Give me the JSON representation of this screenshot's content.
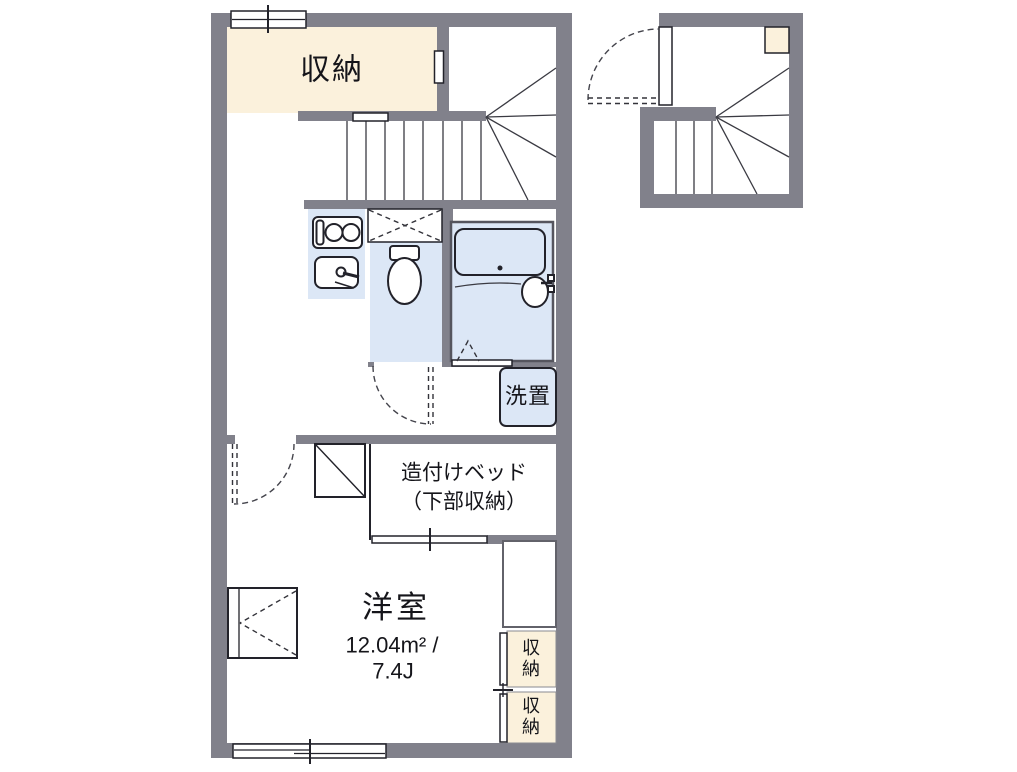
{
  "plan": {
    "labels": {
      "storage_top": "収納",
      "laundry": "洗置",
      "bed_line1": "造付けベッド",
      "bed_line2": "（下部収納）",
      "room_name": "洋室",
      "room_area": "12.04m² /",
      "room_size": "7.4J",
      "closet_upper": "収納",
      "closet_lower": "収納"
    },
    "colors": {
      "wall": "#81818b",
      "storage_fill": "#fbf1dc",
      "water_fill": "#dce7f6",
      "line": "#22222a",
      "background": "#ffffff"
    }
  }
}
